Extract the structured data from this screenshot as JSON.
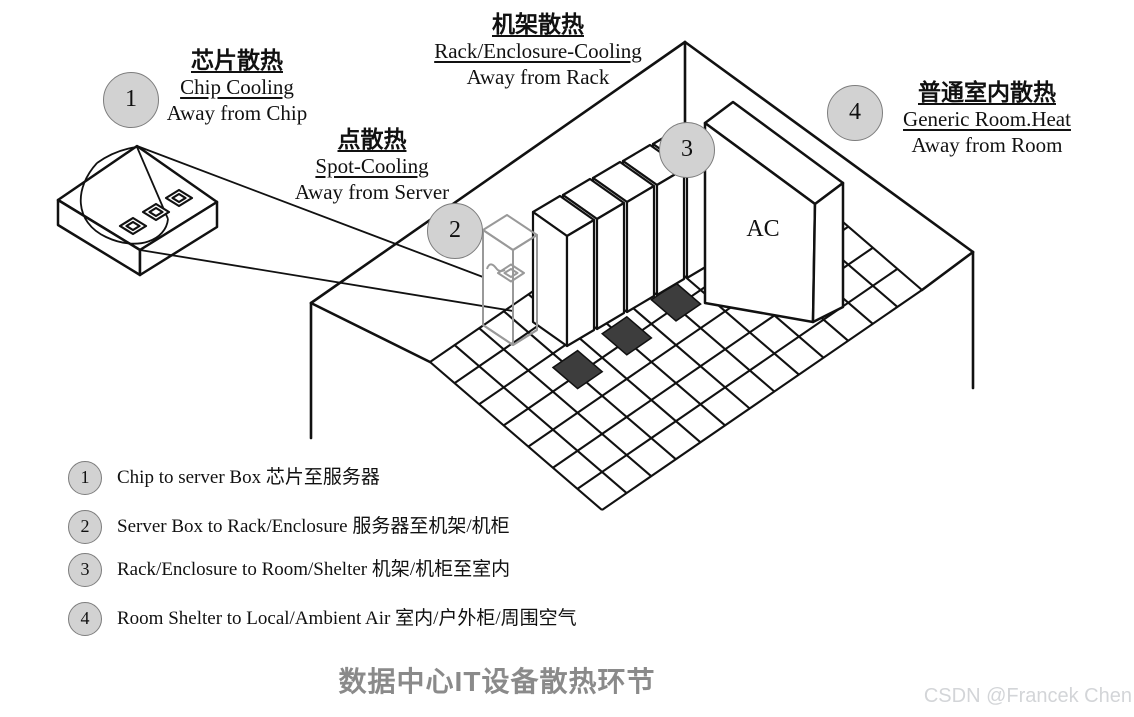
{
  "stages": [
    {
      "num": "1",
      "title_zh": "芯片散热",
      "title_en": "Chip Cooling",
      "subtitle": "Away from Chip"
    },
    {
      "num": "2",
      "title_zh": "点散热",
      "title_en": "Spot-Cooling",
      "subtitle": "Away from Server"
    },
    {
      "num": "3",
      "title_zh": "机架散热",
      "title_en": "Rack/Enclosure-Cooling",
      "subtitle": "Away from Rack"
    },
    {
      "num": "4",
      "title_zh": "普通室内散热",
      "title_en": "Generic Room.Heat",
      "subtitle": "Away from Room"
    }
  ],
  "room": {
    "ac_label": "AC"
  },
  "legend": {
    "items": [
      {
        "num": "1",
        "text": "Chip to server Box 芯片至服务器"
      },
      {
        "num": "2",
        "text": "Server Box to Rack/Enclosure 服务器至机架/机柜"
      },
      {
        "num": "3",
        "text": "Rack/Enclosure to Room/Shelter 机架/机柜至室内"
      },
      {
        "num": "4",
        "text": "Room Shelter to Local/Ambient Air 室内/户外柜/周围空气"
      }
    ]
  },
  "caption": "数据中心IT设备散热环节",
  "watermark": "CSDN @Francek Chen",
  "colors": {
    "line": "#111111",
    "marker_fill": "#d2d2d2",
    "marker_border": "#7d7d7d",
    "highlight_rack": "#999999",
    "dark_tile": "#3d3d3d",
    "caption": "#8a8a8a",
    "watermark": "#d3d5d8"
  }
}
